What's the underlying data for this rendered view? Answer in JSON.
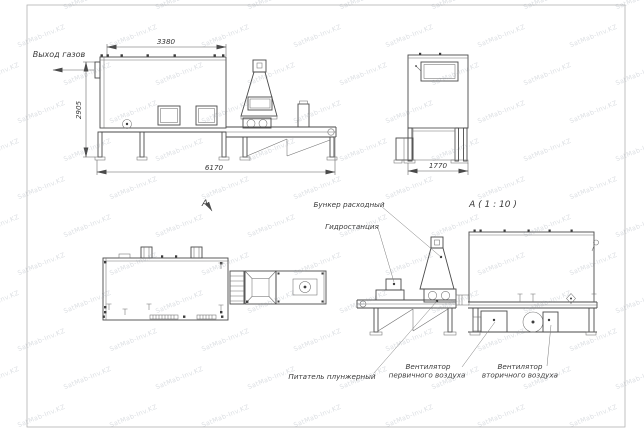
{
  "watermark": {
    "text": "SatMab-Inv.KZ"
  },
  "sheet": {
    "side_view": {
      "gas_outlet_label": "Выход газов",
      "dim_top": "3380",
      "dim_left": "2905",
      "dim_bottom": "6170"
    },
    "end_view": {
      "dim_bottom": "1770"
    },
    "plan_view": {
      "section_label": "А"
    },
    "detail_view": {
      "title": "А ( 1 : 10 )",
      "labels": {
        "hopper": "Бункер расходный",
        "hydraulic_station": "Гидростанция",
        "plunger_feeder": "Питатель плунжерный",
        "primary_fan_l1": "Вентилятор",
        "primary_fan_l2": "первичного воздуха",
        "secondary_fan_l1": "Вентилятор",
        "secondary_fan_l2": "вторичного воздуха"
      }
    }
  }
}
